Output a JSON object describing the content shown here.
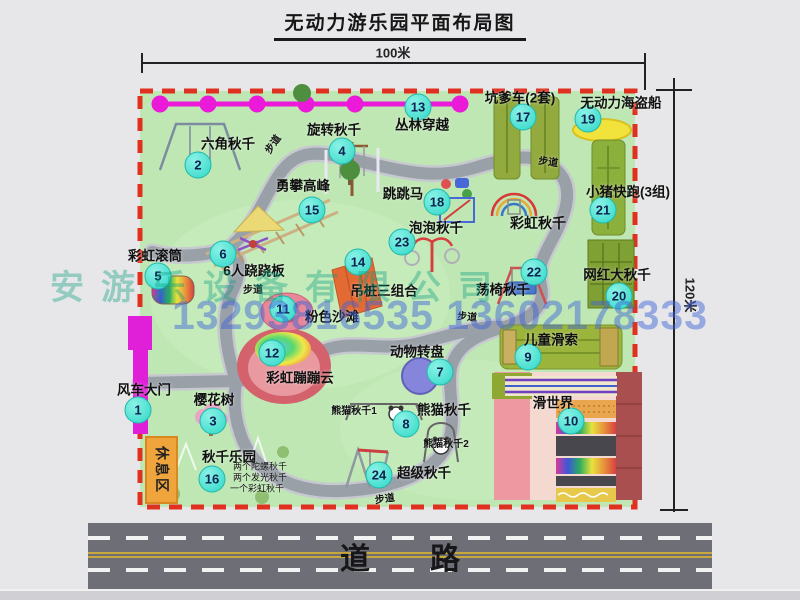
{
  "title": "无动力游乐园平面布局图",
  "dimensions": {
    "width": "100米",
    "height": "120米"
  },
  "road": {
    "label": "道　　路"
  },
  "watermark": {
    "company": "安游乐设备有限公司",
    "phone": "13293816535 13602178333"
  },
  "rest_area_label": "休息区",
  "colors": {
    "map_green": "#bfe7b4",
    "border_red": "#e03020",
    "marker_teal": "#2ed8c8",
    "gate_magenta": "#e020d8",
    "rest_orange": "#f0a43c",
    "road_gray": "#6e6e76",
    "facility_olive": "#8fae3e",
    "pirate_yellow": "#f2e23c",
    "path_gray": "#9aa0a8"
  },
  "markers": [
    {
      "num": "1",
      "label": "风车大门",
      "cx": 138,
      "cy": 410,
      "lx": 144,
      "ly": 390
    },
    {
      "num": "2",
      "label": "六角秋千",
      "cx": 198,
      "cy": 165,
      "lx": 228,
      "ly": 144
    },
    {
      "num": "3",
      "label": "樱花树",
      "cx": 213,
      "cy": 421,
      "lx": 214,
      "ly": 400
    },
    {
      "num": "4",
      "label": "旋转秋千",
      "cx": 342,
      "cy": 151,
      "lx": 334,
      "ly": 130
    },
    {
      "num": "5",
      "label": "彩虹滚筒",
      "cx": 158,
      "cy": 276,
      "lx": 155,
      "ly": 256
    },
    {
      "num": "6",
      "label": "6人跷跷板",
      "cx": 223,
      "cy": 254,
      "lx": 254,
      "ly": 271
    },
    {
      "num": "7",
      "label": "动物转盘",
      "cx": 440,
      "cy": 372,
      "lx": 417,
      "ly": 352
    },
    {
      "num": "8",
      "label": "熊猫秋千",
      "cx": 406,
      "cy": 424,
      "lx": 444,
      "ly": 410
    },
    {
      "num": "9",
      "label": "儿童滑索",
      "cx": 528,
      "cy": 357,
      "lx": 551,
      "ly": 340
    },
    {
      "num": "10",
      "label": "滑世界",
      "cx": 571,
      "cy": 421,
      "lx": 553,
      "ly": 403
    },
    {
      "num": "11",
      "label": "粉色沙滩",
      "cx": 283,
      "cy": 309,
      "lx": 332,
      "ly": 317
    },
    {
      "num": "12",
      "label": "彩虹蹦蹦云",
      "cx": 272,
      "cy": 353,
      "lx": 300,
      "ly": 378
    },
    {
      "num": "13",
      "label": "丛林穿越",
      "cx": 418,
      "cy": 107,
      "lx": 422,
      "ly": 125
    },
    {
      "num": "14",
      "label": "吊桩三组合",
      "cx": 358,
      "cy": 262,
      "lx": 384,
      "ly": 291
    },
    {
      "num": "15",
      "label": "勇攀高峰",
      "cx": 312,
      "cy": 210,
      "lx": 303,
      "ly": 186
    },
    {
      "num": "16",
      "label": "秋千乐园",
      "cx": 212,
      "cy": 479,
      "lx": 229,
      "ly": 457
    },
    {
      "num": "17",
      "label": "坑爹车(2套)",
      "cx": 523,
      "cy": 117,
      "lx": 520,
      "ly": 98
    },
    {
      "num": "18",
      "label": "跳跳马",
      "cx": 437,
      "cy": 202,
      "lx": 403,
      "ly": 194
    },
    {
      "num": "19",
      "label": "无动力海盗船",
      "cx": 588,
      "cy": 119,
      "lx": 621,
      "ly": 103
    },
    {
      "num": "20",
      "label": "网红大秋千",
      "cx": 619,
      "cy": 296,
      "lx": 617,
      "ly": 275
    },
    {
      "num": "21",
      "label": "小猪快跑(3组)",
      "cx": 603,
      "cy": 210,
      "lx": 628,
      "ly": 192
    },
    {
      "num": "22",
      "label": "荡椅秋千",
      "cx": 534,
      "cy": 272,
      "lx": 503,
      "ly": 290
    },
    {
      "num": "23",
      "label": "泡泡秋千",
      "cx": 402,
      "cy": 242,
      "lx": 436,
      "ly": 228
    },
    {
      "num": "24",
      "label": "超级秋千",
      "cx": 379,
      "cy": 475,
      "lx": 424,
      "ly": 473
    }
  ],
  "small_labels": [
    {
      "text": "彩虹秋千",
      "x": 538,
      "y": 223,
      "fs": 14,
      "bold": true
    },
    {
      "text": "熊猫秋千1",
      "x": 354,
      "y": 412,
      "fs": 10,
      "bold": true
    },
    {
      "text": "熊猫秋千2",
      "x": 446,
      "y": 445,
      "fs": 10,
      "bold": true
    },
    {
      "text": "两个陀螺秋千",
      "x": 260,
      "y": 467,
      "fs": 9,
      "bold": false
    },
    {
      "text": "两个发光秋千",
      "x": 260,
      "y": 478,
      "fs": 9,
      "bold": false
    },
    {
      "text": "一个彩虹秋千",
      "x": 257,
      "y": 489,
      "fs": 9,
      "bold": false
    },
    {
      "text": "步道",
      "x": 274,
      "y": 145,
      "fs": 10,
      "rot": -55,
      "bold": true
    },
    {
      "text": "步道",
      "x": 548,
      "y": 163,
      "fs": 10,
      "rot": 8,
      "bold": true
    },
    {
      "text": "步道",
      "x": 253,
      "y": 291,
      "fs": 10,
      "rot": 0,
      "bold": true
    },
    {
      "text": "步道",
      "x": 467,
      "y": 318,
      "fs": 10,
      "rot": 5,
      "bold": true
    },
    {
      "text": "步道",
      "x": 385,
      "y": 500,
      "fs": 10,
      "rot": -8,
      "bold": true
    }
  ]
}
